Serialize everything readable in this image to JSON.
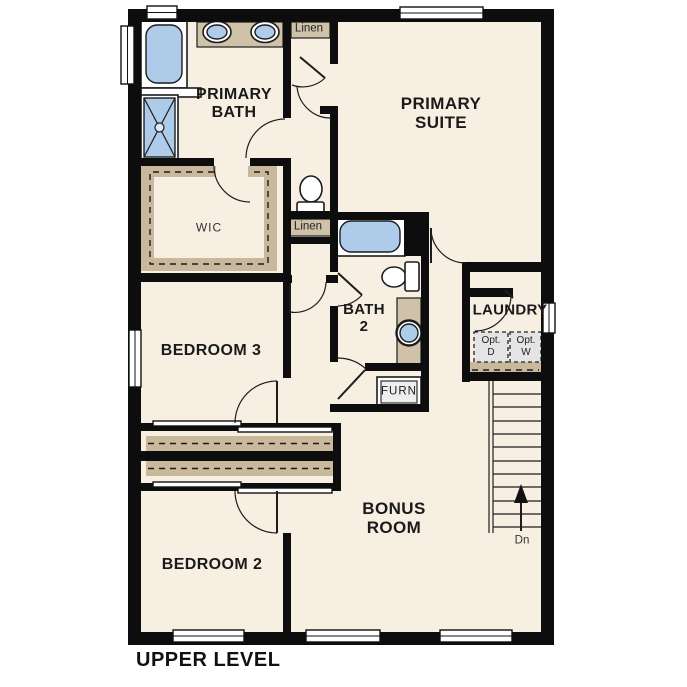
{
  "plan": {
    "title": "UPPER LEVEL",
    "level": "Upper Level floor plan"
  },
  "labels": {
    "primary_bath": [
      "PRIMARY",
      "BATH"
    ],
    "primary_suite": [
      "PRIMARY",
      "SUITE"
    ],
    "wic": "WIC",
    "linen_top": "Linen",
    "linen_mid": "Linen",
    "bath2": [
      "BATH",
      "2"
    ],
    "laundry": "LAUNDRY",
    "opt_dryer": [
      "Opt.",
      "D"
    ],
    "opt_washer": [
      "Opt.",
      "W"
    ],
    "furnace": "FURN",
    "bedroom3": "BEDROOM 3",
    "bedroom2": "BEDROOM 2",
    "bonus_room": [
      "BONUS",
      "ROOM"
    ],
    "stairs_down": "Dn"
  },
  "colors": {
    "wall": "#0d0d0d",
    "floor": "#f8efe3",
    "cabinet_tan": "#cfc2a8",
    "shelf_tan": "#c9b89b",
    "fixture_blue": "#aecbe9",
    "appliance_gray": "#e4e4e4"
  }
}
